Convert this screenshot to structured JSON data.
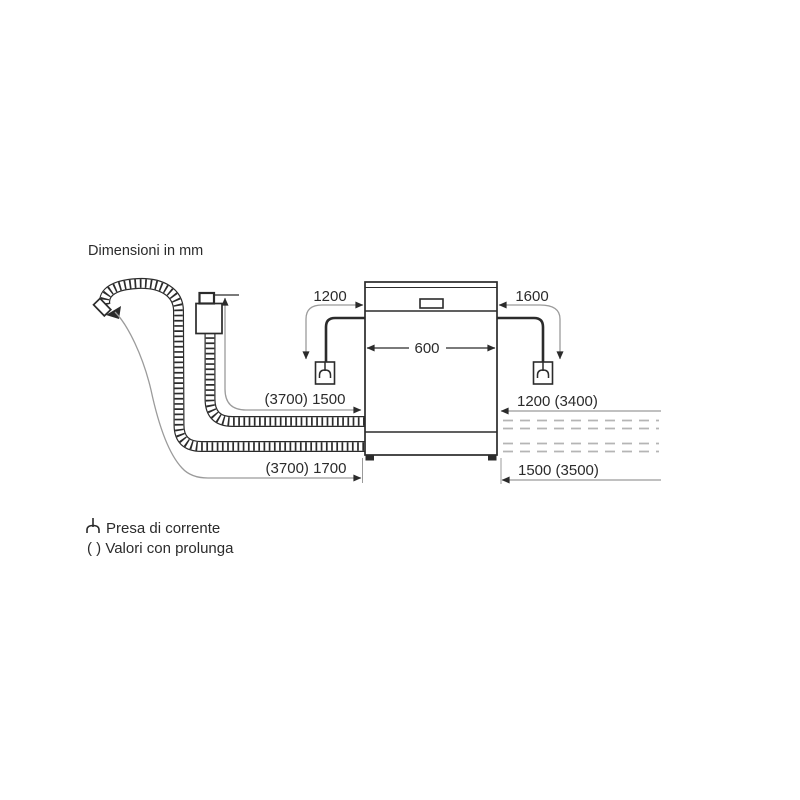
{
  "title": "Dimensioni in mm",
  "colors": {
    "line": "#2b2b2b",
    "dimension_line": "#9b9b9b",
    "dashed_extension": "#b5b5b5",
    "background": "#ffffff"
  },
  "dimensions": {
    "power_cord_left": "1200",
    "power_cord_right": "1600",
    "appliance_width": "600",
    "supply_hose": "(3700) 1500",
    "drain_hose": "(3700) 1700",
    "right_upper_hose": "1200 (3400)",
    "right_lower_hose": "1500 (3500)"
  },
  "legend": {
    "socket_label": "Presa di corrente",
    "extension_label": "( ) Valori con prolunga"
  }
}
